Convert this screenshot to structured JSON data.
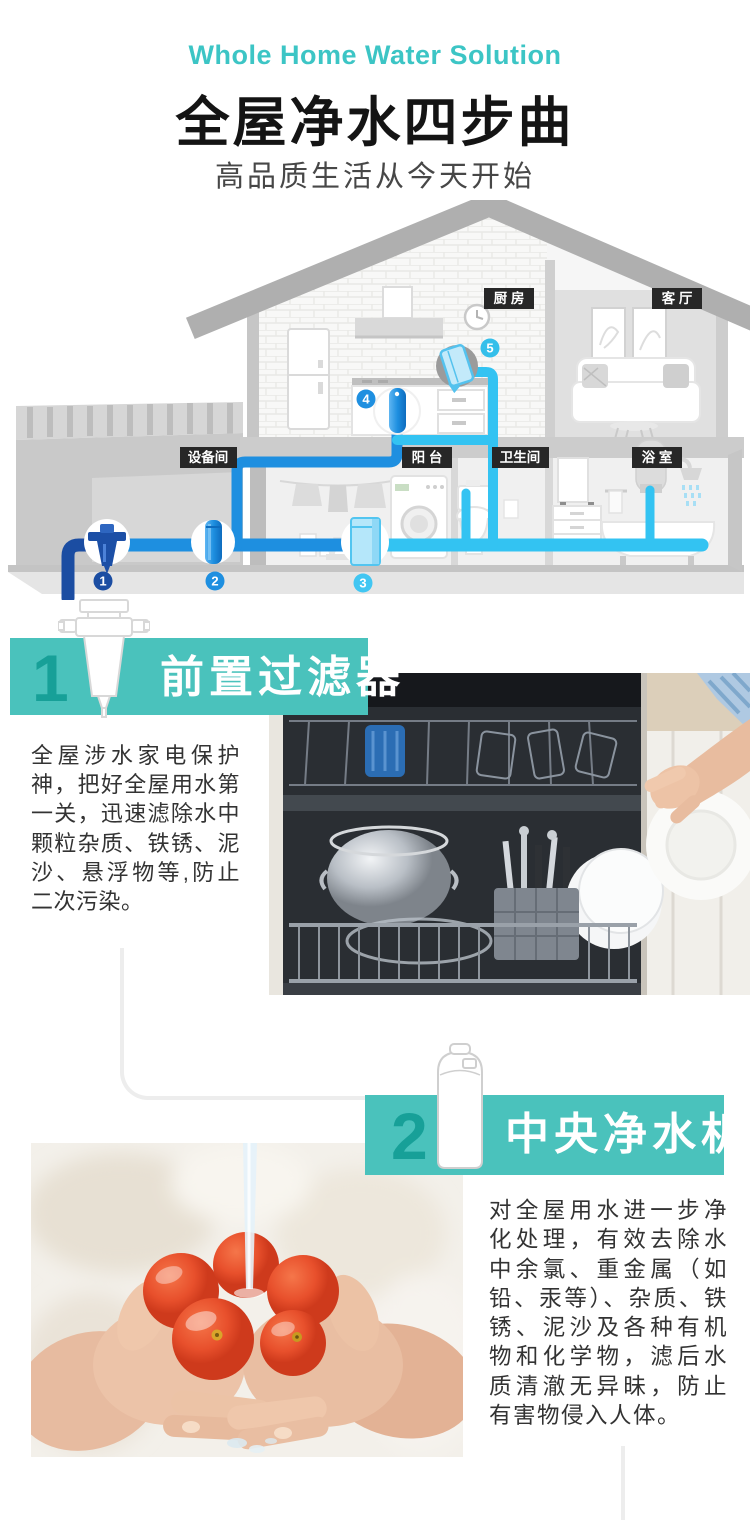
{
  "header": {
    "en_title": "Whole Home Water Solution",
    "title": "全屋净水四步曲",
    "subtitle": "高品质生活从今天开始"
  },
  "house": {
    "labels": {
      "equipment": "设备间",
      "balcony": "阳 台",
      "toilet": "卫生间",
      "bath": "浴 室",
      "kitchen": "厨 房",
      "living": "客 厅"
    },
    "markers": {
      "m1": "1",
      "m2": "2",
      "m3": "3",
      "m4": "4",
      "m5": "5"
    }
  },
  "sections": [
    {
      "number": "1",
      "title": "前置过滤器",
      "body": "全屋涉水家电保护神，把好全屋用水第一关，迅速滤除水中颗粒杂质、铁锈、泥沙、悬浮物等,防止二次污染。"
    },
    {
      "number": "2",
      "title": "中央净水机",
      "body": "对全屋用水进一步净化处理，有效去除水中余氯、重金属（如铅、汞等）、杂质、铁锈、泥沙及各种有机物和化学物，滤后水质清澈无异昧，防止有害物侵入人体。"
    }
  ],
  "colors": {
    "accent_teal": "#4AC2BC",
    "accent_teal_dark": "#17A098",
    "english_title_teal": "#3CC5C5",
    "marker_blue_dark": "#1B4DA2",
    "marker_blue": "#1E8FE0",
    "marker_cyan": "#41C6F2",
    "pipe_cyan": "#33C3F2",
    "room_badge_bg": "#272727"
  },
  "icons": {
    "step1": "prefilter-icon",
    "step2": "central-purifier-tank-icon"
  }
}
